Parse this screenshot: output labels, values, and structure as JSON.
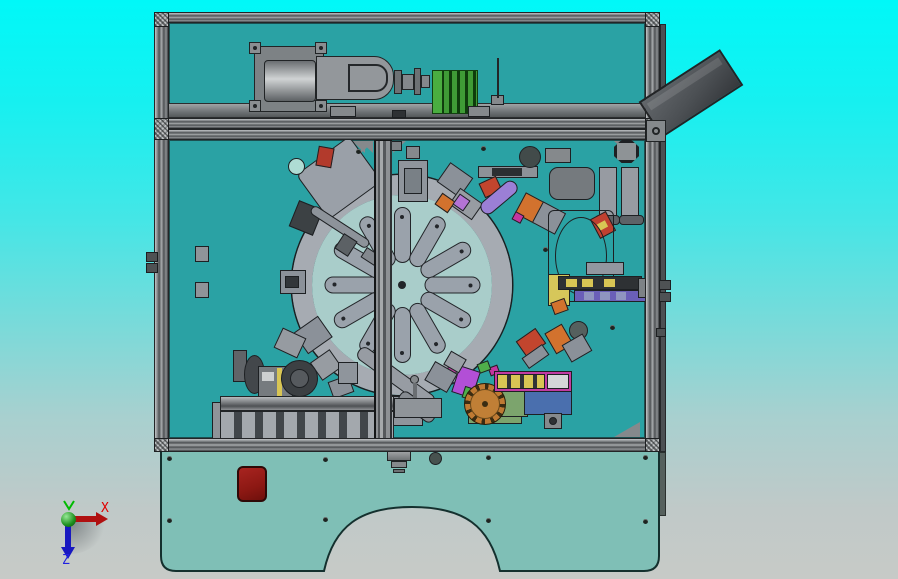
{
  "app": {
    "name": "cad-3d-viewport",
    "view": "top orthographic view of automated assembly machine"
  },
  "axis_triad": {
    "x_label": "X",
    "y_label": "Y",
    "z_label": "Z",
    "x_color": "#e00000",
    "y_color": "#00bb00",
    "z_color": "#2020e0"
  },
  "palette": {
    "background_top": "#00f8f8",
    "background_bottom": "#c7cac7",
    "frame_gray": "#8e9294",
    "panel_teal": "#2aa2a4",
    "skirt_teal": "#7fbfb6",
    "estop_red": "#941c17",
    "heatsink_green": "#2f8429",
    "chute_dark": "#4c5054",
    "gear_orange": "#bf7a33",
    "magenta": "#c13ba2",
    "actuator_yellow": "#d8c554",
    "ring_gray": "#a6abb2",
    "disc_teal": "#a9cdca"
  },
  "turntable": {
    "slot_count": 12,
    "slot_color": "#9aa2ab",
    "ring_color": "#a6abb2",
    "disc_color": "#a9cdca"
  },
  "screws": [
    [
      167,
      456
    ],
    [
      323,
      457
    ],
    [
      486,
      455
    ],
    [
      643,
      455
    ],
    [
      167,
      518
    ],
    [
      323,
      517
    ],
    [
      486,
      518
    ],
    [
      643,
      519
    ],
    [
      481,
      146
    ],
    [
      356,
      149
    ],
    [
      543,
      247
    ],
    [
      610,
      325
    ]
  ],
  "stations": [
    {
      "name": "tilted-plate",
      "x": 306,
      "y": 150,
      "w": 66,
      "h": 56,
      "rot": -36,
      "color": "#9aa0a8",
      "r": 6
    },
    {
      "name": "clamp-dark-head",
      "x": 293,
      "y": 204,
      "w": 26,
      "h": 28,
      "rot": 22,
      "color": "#3c4144"
    },
    {
      "name": "clamp-rod",
      "x": 306,
      "y": 222,
      "w": 68,
      "h": 10,
      "rot": 33,
      "color": "#8d939a",
      "r": 5
    },
    {
      "name": "rod-collar",
      "x": 338,
      "y": 236,
      "w": 16,
      "h": 18,
      "rot": 33,
      "color": "#5c6165"
    },
    {
      "name": "rod-tip",
      "x": 362,
      "y": 252,
      "w": 22,
      "h": 12,
      "rot": 33,
      "color": "#83888e"
    },
    {
      "name": "red-part-topleft",
      "x": 317,
      "y": 147,
      "w": 16,
      "h": 20,
      "rot": 10,
      "color": "#b23a2c"
    },
    {
      "name": "panel-hole-topleft",
      "x": 288,
      "y": 158,
      "w": 17,
      "h": 17,
      "color": "#aedcd4",
      "shape": "circle"
    },
    {
      "name": "fixture-12oclock",
      "x": 398,
      "y": 160,
      "w": 30,
      "h": 42,
      "color": "#8f959c"
    },
    {
      "name": "fixture-12oclock-inner",
      "x": 404,
      "y": 168,
      "w": 18,
      "h": 26,
      "color": "#798086"
    },
    {
      "name": "t-handle",
      "x": 406,
      "y": 146,
      "w": 14,
      "h": 13,
      "color": "#85898d"
    },
    {
      "name": "fixture-1oclock-a",
      "x": 441,
      "y": 168,
      "w": 28,
      "h": 24,
      "rot": 35,
      "color": "#8b9199"
    },
    {
      "name": "fixture-1oclock-b",
      "x": 452,
      "y": 194,
      "w": 28,
      "h": 20,
      "rot": 35,
      "color": "#979ca2"
    },
    {
      "name": "orange-1oclock",
      "x": 437,
      "y": 196,
      "w": 16,
      "h": 14,
      "rot": 35,
      "color": "#d2722e"
    },
    {
      "name": "purple-square-1oclock",
      "x": 455,
      "y": 196,
      "w": 13,
      "h": 13,
      "rot": 35,
      "color": "#b473d6"
    },
    {
      "name": "linear-rail-top",
      "x": 478,
      "y": 166,
      "w": 60,
      "h": 12,
      "color": "#8d9298"
    },
    {
      "name": "linear-rail-top-dark",
      "x": 492,
      "y": 168,
      "w": 30,
      "h": 8,
      "color": "#2b2e31",
      "noborder": true
    },
    {
      "name": "red-gripper",
      "x": 481,
      "y": 179,
      "w": 19,
      "h": 16,
      "rot": -25,
      "color": "#c2452e"
    },
    {
      "name": "purple-cylinder",
      "x": 477,
      "y": 190,
      "w": 44,
      "h": 15,
      "rot": -40,
      "color": "#9b7fd6",
      "r": 8
    },
    {
      "name": "camera-circle",
      "x": 519,
      "y": 146,
      "w": 22,
      "h": 22,
      "color": "#424b4a",
      "shape": "circle"
    },
    {
      "name": "bracket-topright",
      "x": 545,
      "y": 148,
      "w": 26,
      "h": 15,
      "color": "#85898c"
    },
    {
      "name": "rounded-box-right",
      "x": 549,
      "y": 167,
      "w": 46,
      "h": 33,
      "color": "#757a7e",
      "r": 9
    },
    {
      "name": "octagon-knob",
      "x": 614,
      "y": 140,
      "w": 25,
      "h": 23,
      "color": "#8e9396",
      "shape": "octagon"
    },
    {
      "name": "guide-plate-a",
      "x": 599,
      "y": 167,
      "w": 18,
      "h": 52,
      "color": "#979ba2"
    },
    {
      "name": "guide-plate-b",
      "x": 621,
      "y": 167,
      "w": 18,
      "h": 52,
      "color": "#979ba2"
    },
    {
      "name": "guide-plate-a-cap",
      "x": 595,
      "y": 215,
      "w": 25,
      "h": 10,
      "color": "#5d6267",
      "r": 4
    },
    {
      "name": "guide-plate-b-cap",
      "x": 619,
      "y": 215,
      "w": 25,
      "h": 10,
      "color": "#5d6267",
      "r": 4
    },
    {
      "name": "orange-2oclock",
      "x": 519,
      "y": 196,
      "w": 22,
      "h": 24,
      "rot": 28,
      "color": "#d2722e"
    },
    {
      "name": "fixture-2oclock",
      "x": 536,
      "y": 206,
      "w": 26,
      "h": 24,
      "rot": 28,
      "color": "#8b9199"
    },
    {
      "name": "magenta-2oclock",
      "x": 513,
      "y": 213,
      "w": 10,
      "h": 9,
      "rot": 28,
      "color": "#c435a0"
    },
    {
      "name": "red-3oclock",
      "x": 594,
      "y": 214,
      "w": 18,
      "h": 22,
      "rot": -28,
      "color": "#c04030"
    },
    {
      "name": "yellow-3oclock",
      "x": 598,
      "y": 222,
      "w": 9,
      "h": 7,
      "rot": -28,
      "color": "#d8c554",
      "noborder": true
    },
    {
      "name": "bowl-feeder-frame",
      "x": 548,
      "y": 210,
      "w": 66,
      "h": 92,
      "color": "transparent",
      "r": 6
    },
    {
      "name": "bowl-feeder-ring",
      "x": 555,
      "y": 217,
      "w": 52,
      "h": 78,
      "color": "transparent",
      "shape": "circle"
    },
    {
      "name": "panel-hole-right",
      "x": 569,
      "y": 321,
      "w": 19,
      "h": 19,
      "color": "#55605e",
      "shape": "circle"
    },
    {
      "name": "yellow-block-3oclock",
      "x": 548,
      "y": 274,
      "w": 22,
      "h": 32,
      "color": "#d6c75a"
    },
    {
      "name": "dark-rail-3oclock",
      "x": 558,
      "y": 276,
      "w": 84,
      "h": 14,
      "color": "#2e3134"
    },
    {
      "name": "yellow-cell-1",
      "x": 566,
      "y": 279,
      "w": 11,
      "h": 8,
      "color": "#d8c554",
      "noborder": true
    },
    {
      "name": "yellow-cell-2",
      "x": 582,
      "y": 279,
      "w": 11,
      "h": 8,
      "color": "#d8c554",
      "noborder": true
    },
    {
      "name": "yellow-cell-3",
      "x": 604,
      "y": 279,
      "w": 11,
      "h": 8,
      "color": "#d8c554",
      "noborder": true
    },
    {
      "name": "purple-rail-3oclock",
      "x": 574,
      "y": 290,
      "w": 78,
      "h": 12,
      "color": "#6a5fb8"
    },
    {
      "name": "purple-rail-cell-1",
      "x": 584,
      "y": 292,
      "w": 10,
      "h": 8,
      "color": "#8f95c0",
      "noborder": true
    },
    {
      "name": "purple-rail-cell-2",
      "x": 600,
      "y": 292,
      "w": 10,
      "h": 8,
      "color": "#8f95c0",
      "noborder": true
    },
    {
      "name": "purple-rail-cell-3",
      "x": 616,
      "y": 292,
      "w": 10,
      "h": 8,
      "color": "#8f95c0",
      "noborder": true
    },
    {
      "name": "gray-strip-3oclock",
      "x": 586,
      "y": 262,
      "w": 38,
      "h": 13,
      "color": "#9297a0"
    },
    {
      "name": "clamp-3oclock",
      "x": 638,
      "y": 278,
      "w": 12,
      "h": 20,
      "color": "#7d8286"
    },
    {
      "name": "orange-4oclock",
      "x": 552,
      "y": 300,
      "w": 15,
      "h": 13,
      "rot": -20,
      "color": "#d2722e"
    },
    {
      "name": "red-5oclock",
      "x": 519,
      "y": 333,
      "w": 24,
      "h": 19,
      "rot": -35,
      "color": "#c2452e"
    },
    {
      "name": "gray-5oclock",
      "x": 523,
      "y": 350,
      "w": 25,
      "h": 13,
      "rot": -35,
      "color": "#8b9199"
    },
    {
      "name": "orange-5oclock",
      "x": 549,
      "y": 327,
      "w": 20,
      "h": 24,
      "rot": -30,
      "color": "#d2722e"
    },
    {
      "name": "fixture-5oclock",
      "x": 565,
      "y": 338,
      "w": 24,
      "h": 20,
      "rot": -30,
      "color": "#8b9199"
    },
    {
      "name": "purple-6oclock",
      "x": 455,
      "y": 368,
      "w": 22,
      "h": 28,
      "rot": 18,
      "color": "#b24fd6"
    },
    {
      "name": "green-6oclock",
      "x": 463,
      "y": 388,
      "w": 16,
      "h": 12,
      "rot": 18,
      "color": "#4fae4a"
    },
    {
      "name": "magenta-6oclock",
      "x": 447,
      "y": 366,
      "w": 10,
      "h": 9,
      "rot": 18,
      "color": "#c435a0"
    },
    {
      "name": "yellow-6oclock",
      "x": 477,
      "y": 384,
      "w": 8,
      "h": 7,
      "rot": 18,
      "color": "#d8c554",
      "noborder": true
    },
    {
      "name": "fixture-6oclock",
      "x": 389,
      "y": 396,
      "w": 34,
      "h": 30,
      "color": "#8f959c"
    },
    {
      "name": "transfer-arm",
      "x": 350,
      "y": 370,
      "w": 92,
      "h": 15,
      "rot": 36,
      "color": "#979ca3",
      "r": 7
    },
    {
      "name": "transfer-arm-lower",
      "x": 396,
      "y": 400,
      "w": 42,
      "h": 14,
      "rot": 36,
      "color": "#868b91",
      "r": 6
    },
    {
      "name": "gray-7oclock",
      "x": 428,
      "y": 366,
      "w": 26,
      "h": 22,
      "rot": 30,
      "color": "#8b9199"
    },
    {
      "name": "gray-7oclock-b",
      "x": 446,
      "y": 354,
      "w": 18,
      "h": 16,
      "rot": 30,
      "color": "#9aa0a6"
    },
    {
      "name": "fixture-8oclock",
      "x": 298,
      "y": 322,
      "w": 30,
      "h": 26,
      "rot": -35,
      "color": "#8b9199"
    },
    {
      "name": "fixture-8oclock-b",
      "x": 314,
      "y": 354,
      "w": 24,
      "h": 22,
      "rot": -35,
      "color": "#979ca2"
    },
    {
      "name": "fixture-7oclock",
      "x": 330,
      "y": 378,
      "w": 22,
      "h": 18,
      "rot": -20,
      "color": "#8b9199"
    },
    {
      "name": "fixture-7oclock-b",
      "x": 338,
      "y": 362,
      "w": 20,
      "h": 22,
      "color": "#8f959c"
    },
    {
      "name": "fixture-9oclock",
      "x": 280,
      "y": 270,
      "w": 26,
      "h": 24,
      "color": "#8b9199"
    },
    {
      "name": "fixture-9oclock-inner",
      "x": 285,
      "y": 276,
      "w": 14,
      "h": 12,
      "color": "#32363a"
    },
    {
      "name": "fixture-9oclock-b",
      "x": 277,
      "y": 332,
      "w": 26,
      "h": 22,
      "rot": 25,
      "color": "#969ba1"
    },
    {
      "name": "wall-bracket-1",
      "x": 195,
      "y": 246,
      "w": 14,
      "h": 16,
      "color": "#8f9499"
    },
    {
      "name": "wall-bracket-2",
      "x": 195,
      "y": 282,
      "w": 14,
      "h": 16,
      "color": "#8f9499"
    },
    {
      "name": "gear-base-plate",
      "x": 468,
      "y": 396,
      "w": 54,
      "h": 28,
      "color": "#7ca46d"
    },
    {
      "name": "green-dotted-plate",
      "x": 492,
      "y": 387,
      "w": 36,
      "h": 30,
      "color": "#7ca46d"
    },
    {
      "name": "blue-box",
      "x": 524,
      "y": 391,
      "w": 48,
      "h": 24,
      "color": "#4a6fae"
    },
    {
      "name": "unit-foot",
      "x": 544,
      "y": 413,
      "w": 18,
      "h": 16,
      "color": "#85898c"
    },
    {
      "name": "unit-foot-hole",
      "x": 549,
      "y": 417,
      "w": 8,
      "h": 8,
      "color": "#2e3134",
      "shape": "circle"
    },
    {
      "name": "magenta-gear-bit",
      "x": 489,
      "y": 366,
      "w": 10,
      "h": 9,
      "rot": -20,
      "color": "#c435a0"
    },
    {
      "name": "green-gear-bit",
      "x": 478,
      "y": 362,
      "w": 12,
      "h": 10,
      "rot": -20,
      "color": "#4fae4a"
    },
    {
      "name": "motor-upright",
      "x": 233,
      "y": 350,
      "w": 14,
      "h": 32,
      "color": "#606468"
    },
    {
      "name": "motor-pulley",
      "x": 244,
      "y": 355,
      "w": 21,
      "h": 39,
      "color": "#43474b",
      "shape": "circle"
    },
    {
      "name": "gearbox",
      "x": 258,
      "y": 366,
      "w": 35,
      "h": 32,
      "color": "#767b7f"
    },
    {
      "name": "gearbox-label",
      "x": 262,
      "y": 372,
      "w": 12,
      "h": 9,
      "color": "#cdd0d1",
      "noborder": true
    },
    {
      "name": "yellow-strip",
      "x": 277,
      "y": 368,
      "w": 5,
      "h": 28,
      "color": "#d8c554",
      "noborder": true
    },
    {
      "name": "motor-round",
      "x": 281,
      "y": 360,
      "w": 37,
      "h": 37,
      "color": "#3c4043",
      "shape": "circle"
    },
    {
      "name": "motor-round-inner",
      "x": 290,
      "y": 369,
      "w": 19,
      "h": 19,
      "color": "#565a5e",
      "shape": "circle"
    },
    {
      "name": "sensor-pin-head",
      "x": 410,
      "y": 375,
      "w": 9,
      "h": 9,
      "color": "#85898c",
      "shape": "circle"
    },
    {
      "name": "sensor-pin-stem",
      "x": 413,
      "y": 383,
      "w": 4,
      "h": 18,
      "color": "#6a6e72",
      "noborder": true
    },
    {
      "name": "conveyor-ramp-right",
      "x": 394,
      "y": 398,
      "w": 48,
      "h": 20,
      "color": "#8f9499"
    },
    {
      "name": "conveyor-end-cap",
      "x": 212,
      "y": 402,
      "w": 12,
      "h": 42,
      "color": "#8f9499"
    },
    {
      "name": "shelf-truck-1",
      "x": 330,
      "y": 106,
      "w": 26,
      "h": 11,
      "color": "#85898c"
    },
    {
      "name": "shelf-truck-2",
      "x": 468,
      "y": 106,
      "w": 22,
      "h": 11,
      "color": "#85898c"
    },
    {
      "name": "shelf-block-dark",
      "x": 392,
      "y": 110,
      "w": 14,
      "h": 8,
      "color": "#2e3134"
    },
    {
      "name": "needle-base",
      "x": 491,
      "y": 95,
      "w": 13,
      "h": 10,
      "color": "#85898c"
    },
    {
      "name": "needle",
      "x": 497,
      "y": 58,
      "w": 2,
      "h": 40,
      "color": "#232527",
      "noborder": true
    },
    {
      "name": "divider-bracket",
      "x": 380,
      "y": 141,
      "w": 22,
      "h": 10,
      "color": "#7d8185"
    }
  ]
}
